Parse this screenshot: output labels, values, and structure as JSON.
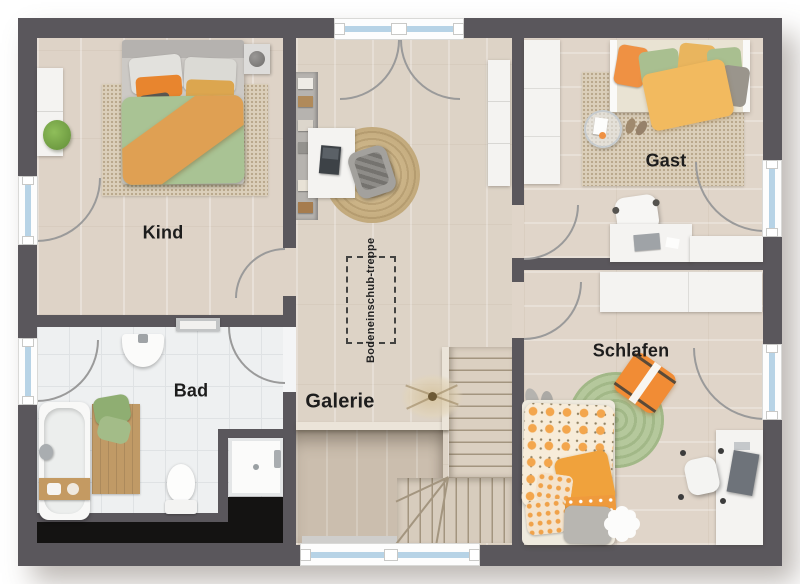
{
  "floorplan": {
    "rooms": {
      "kind": {
        "label": "Kind"
      },
      "bad": {
        "label": "Bad"
      },
      "galerie": {
        "label": "Galerie"
      },
      "gast": {
        "label": "Gast"
      },
      "schlafen": {
        "label": "Schlafen"
      }
    },
    "annotations": {
      "attic_hatch": {
        "line1": "Bodeneinschub-",
        "line2": "treppe"
      }
    },
    "palette": {
      "wall": "#5a575c",
      "wood_floor": "#ddd3c6",
      "tile_floor": "#eef0f1",
      "void_black": "#141312",
      "window_glass": "#b7d3e6",
      "accent_orange": "#ef9143",
      "accent_green": "#a9c394",
      "accent_mustard": "#e9b55e"
    }
  }
}
